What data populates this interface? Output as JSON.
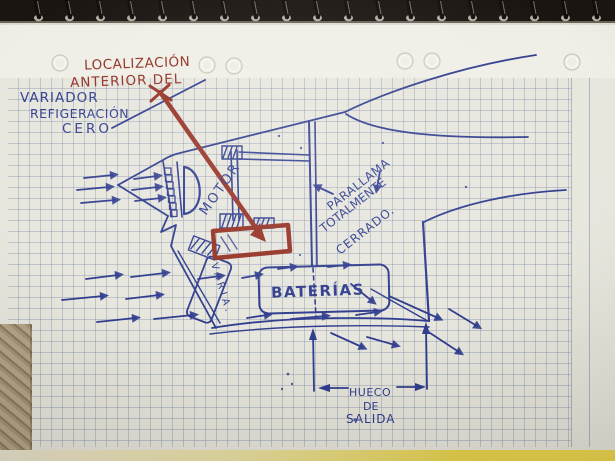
{
  "photo": {
    "alt": "Hand-drawn sketch in blue and red ballpoint pen on squared spiral-notebook paper",
    "ink_colors": {
      "blue": "#2d3a8c",
      "red": "#942f22"
    },
    "paper_color": "#e7e6dd",
    "binding_color": "#15100c",
    "cover_yellow": "#e7d34a"
  },
  "annotations": {
    "red_note": {
      "line1": "LOCALIZACIÓN",
      "line2": "ANTERIOR DEL"
    },
    "blue_note": {
      "line1": "VARIADOR",
      "line2": "REFIGERACIÓN",
      "line3": "CERO"
    },
    "motor": "MOTOR",
    "firewall": {
      "line1": "PARALLAMA",
      "line2": "TOTALMENTE",
      "line3": "CERRADO."
    },
    "batteries": "BATERÍAS",
    "esc_box": "VARIA.",
    "exit": {
      "line1": "HUECO",
      "line2": "DE",
      "line3": "SALIDA"
    }
  }
}
